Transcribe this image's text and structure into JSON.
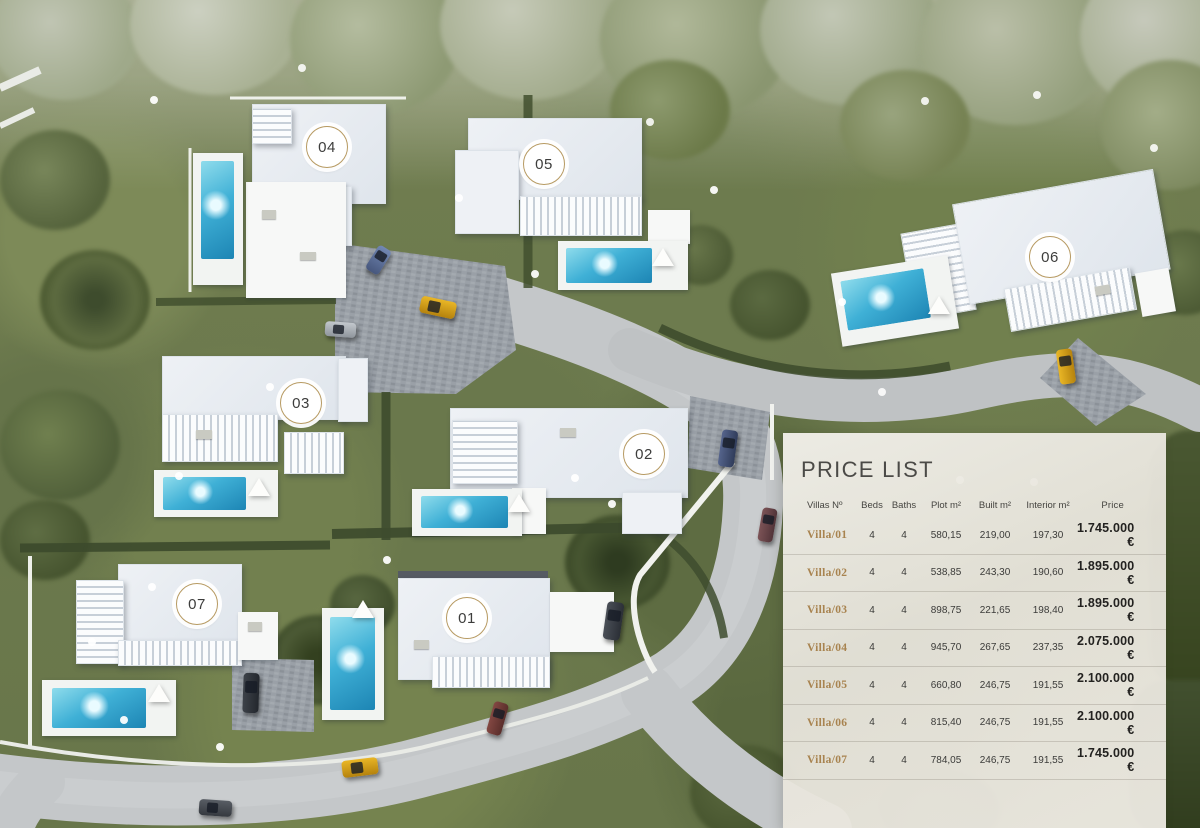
{
  "map": {
    "villas": [
      {
        "number": "01"
      },
      {
        "number": "02"
      },
      {
        "number": "03"
      },
      {
        "number": "04"
      },
      {
        "number": "05"
      },
      {
        "number": "06"
      },
      {
        "number": "07"
      }
    ]
  },
  "price_list": {
    "title": "PRICE LIST",
    "columns": [
      "Villas Nº",
      "Beds",
      "Baths",
      "Plot m²",
      "Built m²",
      "Interior m²",
      "Price"
    ],
    "rows": [
      {
        "villa": "Villa/01",
        "beds": "4",
        "baths": "4",
        "plot": "580,15",
        "built": "219,00",
        "interior": "197,30",
        "price": "1.745.000 €"
      },
      {
        "villa": "Villa/02",
        "beds": "4",
        "baths": "4",
        "plot": "538,85",
        "built": "243,30",
        "interior": "190,60",
        "price": "1.895.000 €"
      },
      {
        "villa": "Villa/03",
        "beds": "4",
        "baths": "4",
        "plot": "898,75",
        "built": "221,65",
        "interior": "198,40",
        "price": "1.895.000 €"
      },
      {
        "villa": "Villa/04",
        "beds": "4",
        "baths": "4",
        "plot": "945,70",
        "built": "267,65",
        "interior": "237,35",
        "price": "2.075.000 €"
      },
      {
        "villa": "Villa/05",
        "beds": "4",
        "baths": "4",
        "plot": "660,80",
        "built": "246,75",
        "interior": "191,55",
        "price": "2.100.000 €"
      },
      {
        "villa": "Villa/06",
        "beds": "4",
        "baths": "4",
        "plot": "815,40",
        "built": "246,75",
        "interior": "191,55",
        "price": "2.100.000 €"
      },
      {
        "villa": "Villa/07",
        "beds": "4",
        "baths": "4",
        "plot": "784,05",
        "built": "246,75",
        "interior": "191,55",
        "price": "1.745.000 €"
      }
    ],
    "colors": {
      "accent_gold": "#a8834f",
      "panel_background": "#e9e6de",
      "badge_ring": "#b79a62",
      "pool_water": "#3fb0d6",
      "road_gray": "#c4c7c9",
      "vegetation_green": "#5d6b40",
      "car_yellow": "#d9a41b"
    }
  }
}
